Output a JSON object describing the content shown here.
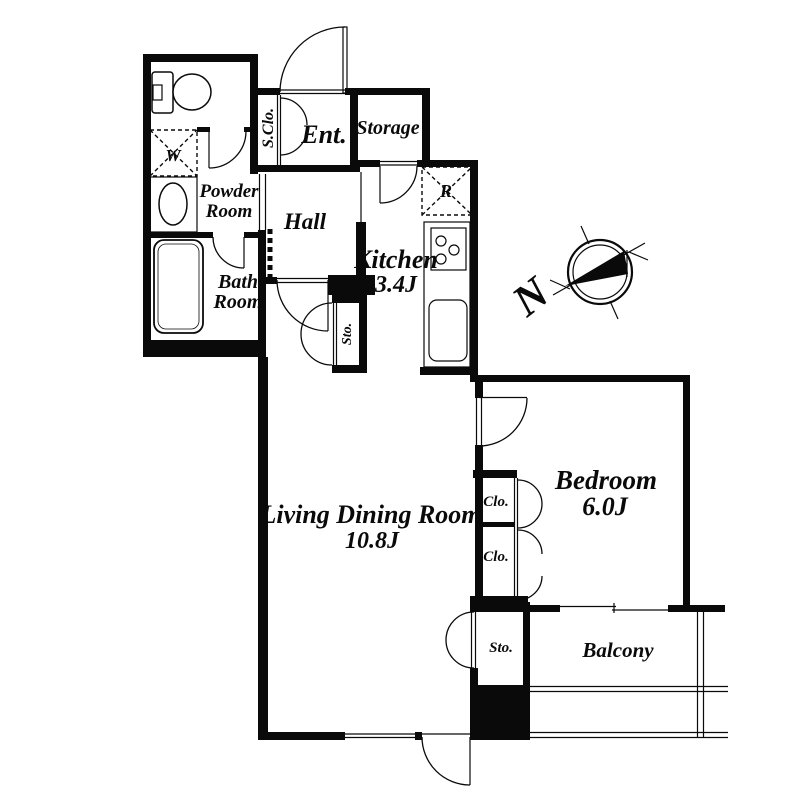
{
  "plan_title": "apartment-floor-plan",
  "colors": {
    "wall": "#0a0a0a",
    "background": "#ffffff"
  },
  "compass": {
    "north": "N"
  },
  "rooms": {
    "ent": {
      "label": "Ent."
    },
    "s_clo": {
      "label": "S.Clo."
    },
    "storage": {
      "label": "Storage"
    },
    "powder": {
      "line1": "Powder",
      "line2": "Room"
    },
    "washer": {
      "label": "W"
    },
    "hall": {
      "label": "Hall"
    },
    "bath": {
      "line1": "Bath",
      "line2": "Room"
    },
    "kitchen": {
      "label": "Kitchen",
      "size": "3.4J"
    },
    "fridge": {
      "label": "R"
    },
    "sto_hall": {
      "label": "Sto."
    },
    "living": {
      "label": "Living Dining Room",
      "size": "10.8J"
    },
    "clo1": {
      "label": "Clo."
    },
    "clo2": {
      "label": "Clo."
    },
    "bedroom": {
      "label": "Bedroom",
      "size": "6.0J"
    },
    "sto_balcony": {
      "label": "Sto."
    },
    "balcony": {
      "label": "Balcony"
    }
  }
}
